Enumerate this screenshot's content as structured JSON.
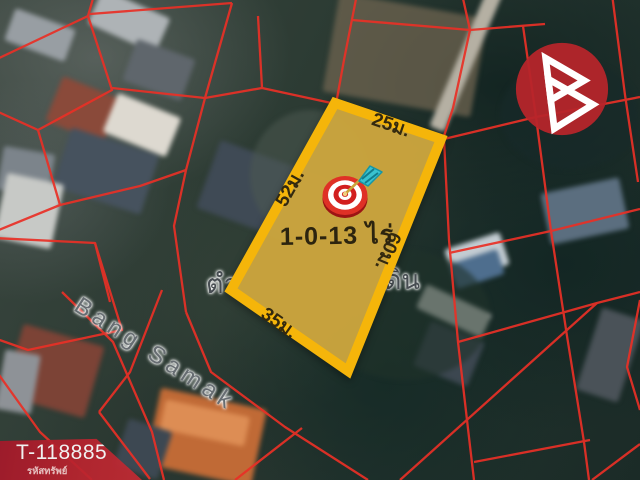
{
  "property": {
    "code": "T-118885",
    "code_caption": "รหัสทรัพย์",
    "area_label": "1-0-13 ไร่",
    "dimensions": {
      "top": "25ม.",
      "left": "52ม.",
      "right": "60ม.",
      "bottom": "35ม."
    }
  },
  "map": {
    "road_label": "Bang Samak",
    "place_label_fragment_left": "ตำ",
    "place_label_fragment_right": "ดิน"
  },
  "icons": {
    "target": "dartboard-direct-hit",
    "logo": "brand-b-triangle-mark"
  },
  "colors": {
    "plot_fill": "#cda73e",
    "plot_border": "#f5b50a",
    "parcel_lines": "#e93026",
    "banner_red": "#b02330",
    "logo_red": "#b7252a",
    "dart_flight": "#39c2cf",
    "road_label_gray": "#676d72"
  }
}
